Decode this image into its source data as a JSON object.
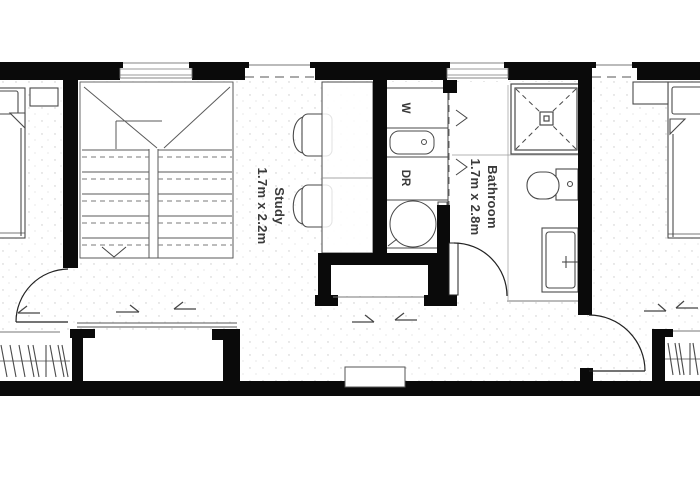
{
  "floorplan": {
    "rooms": {
      "study": {
        "name": "Study",
        "dims": "1.7m x 2.2m"
      },
      "bathroom": {
        "name": "Bathroom",
        "dims": "1.7m x 2.8m"
      }
    },
    "appliances": {
      "washer": "W",
      "dryer": "DR"
    },
    "colors": {
      "wall": "#0a0a0a",
      "furniture_line": "#4a4a4a",
      "light_line": "#8a8a8a",
      "label_text": "#3a3a3a",
      "floor": "#ffffff"
    }
  }
}
